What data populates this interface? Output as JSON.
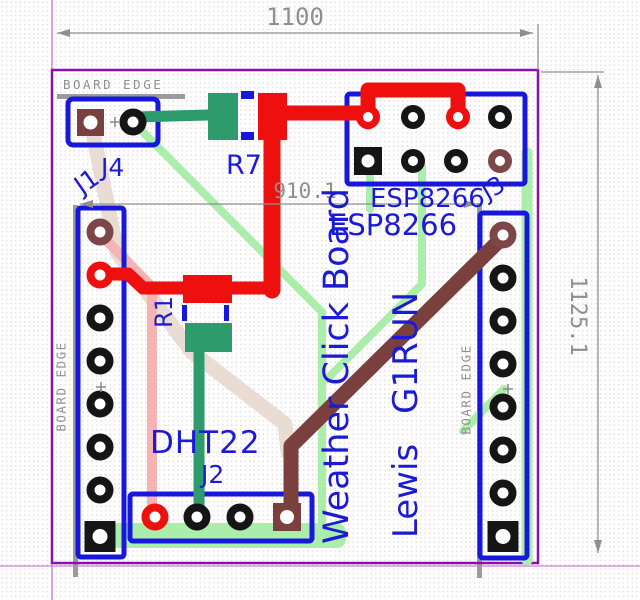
{
  "dimensions": {
    "top_width": "1100",
    "right_height": "1125.1",
    "inner_width": "910.1"
  },
  "board_edge_labels": {
    "top": "BOARD EDGE",
    "left": "BOARD EDGE",
    "right": "BOARD EDGE"
  },
  "references": {
    "j1": "J1",
    "j2": "J2",
    "j3": "J3",
    "j4": "J4",
    "r1": "R1",
    "r7": "R7"
  },
  "silkscreen": {
    "esp_ref": "ESP8266",
    "esp_value": "ESP8266",
    "sensor": "DHT22",
    "board_title": "Weather Click Board",
    "author_name": "Lewis",
    "author_callsign": "G1RUN"
  },
  "colors": {
    "board_edge_purple": "#8a10a8",
    "crosshair_violet": "#c183cf",
    "outline_blue": "#1818dd",
    "text_blue": "#1b1bd6",
    "copper_red": "#ee0f0f",
    "copper_teal": "#2e9b6d",
    "copper_brown": "#7a403d",
    "copper_pink": "#f5b3b3",
    "copper_pale": "#e9dcd5",
    "copper_lightgreen": "#abeeab",
    "dimension_gray": "#8f8f8f",
    "pad_black": "#151515"
  }
}
